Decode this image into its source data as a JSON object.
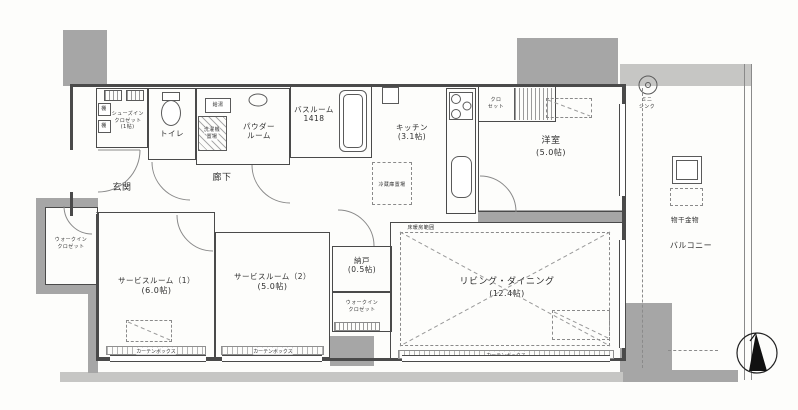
{
  "plan": {
    "wic_left": {
      "line1": "ウォークイン",
      "line2": "クロゼット"
    },
    "shoes_closet": {
      "line1": "シューズイン",
      "line2": "クロゼット",
      "size": "(1帖)"
    },
    "shelf": {
      "label": "棚"
    },
    "entrance": {
      "label": "玄関"
    },
    "toilet": {
      "label": "トイレ"
    },
    "water_heater": {
      "label": "給湯"
    },
    "laundry": {
      "line1": "洗濯機",
      "line2": "置場"
    },
    "powder_room": {
      "line1": "パウダー",
      "line2": "ルーム"
    },
    "bathroom": {
      "label": "バスルーム",
      "size": "1418"
    },
    "hallway": {
      "label": "廊下"
    },
    "kitchen": {
      "label": "キッチン",
      "size": "(3.1帖)"
    },
    "fridge": {
      "label": "冷蔵庫置場"
    },
    "closet": {
      "line1": "クロ",
      "line2": "セット"
    },
    "bedroom": {
      "label": "洋室",
      "size": "(5.0帖)"
    },
    "mini_sink": {
      "line1": "ミニ",
      "line2": "シンク"
    },
    "laundry_pole": {
      "label": "物干金物"
    },
    "balcony": {
      "label": "バルコニー"
    },
    "living": {
      "label": "リビング・ダイニング",
      "size": "(12.4帖)"
    },
    "floor_heating": {
      "label": "床暖房範囲"
    },
    "storage": {
      "label": "納戸",
      "size": "(0.5帖)"
    },
    "wic_center": {
      "line1": "ウォークイン",
      "line2": "クロゼット"
    },
    "service1": {
      "label": "サービスルーム（1）",
      "size": "(6.0帖)"
    },
    "service2": {
      "label": "サービスルーム（2）",
      "size": "(5.0帖)"
    },
    "curtain_box": {
      "label": "カーテンボックス"
    }
  },
  "colors": {
    "line": "#4a4a4a",
    "wall": "#a6a6a6",
    "sill": "#cfcfcd"
  }
}
